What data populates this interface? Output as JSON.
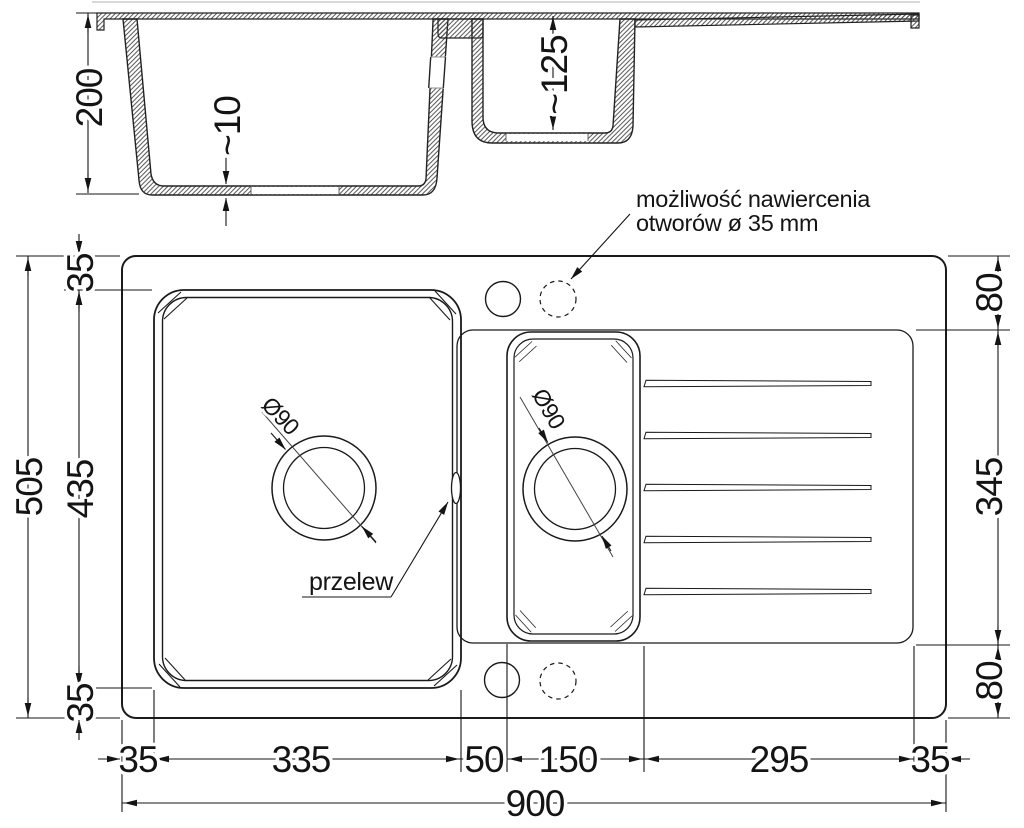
{
  "drawing_type": "kitchen sink technical dimension drawing",
  "colors": {
    "line": "#1a1a1a",
    "dimension": "#141414",
    "hatch": "#4a4a4a",
    "faint_border": "#cccccc"
  },
  "section_view": {
    "overall_depth": "200",
    "bottom_thickness": "~10",
    "small_bowl_depth": "~125"
  },
  "plan_view": {
    "note": {
      "line1": "możliwość nawiercenia",
      "line2": "otworów ø 35 mm"
    },
    "overflow_label": "przelew",
    "main_drain_diameter": "Ø90",
    "small_drain_diameter": "Ø90",
    "dims": {
      "left_top": "35",
      "left_main": "435",
      "left_bottom": "35",
      "left_overall": "505",
      "right_top": "80",
      "right_middle": "345",
      "right_bottom": "80",
      "bottom_1": "35",
      "bottom_2": "335",
      "bottom_3": "50",
      "bottom_4": "150",
      "bottom_5": "295",
      "bottom_6": "35",
      "bottom_overall": "900"
    }
  }
}
